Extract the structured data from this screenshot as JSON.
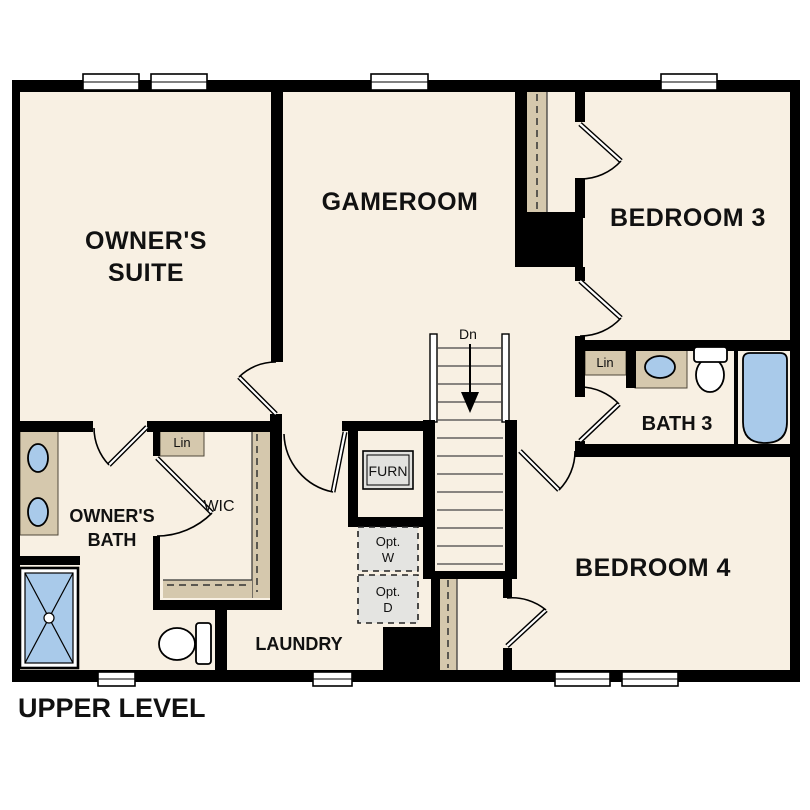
{
  "title": "UPPER LEVEL",
  "rooms": {
    "owners_suite": {
      "line1": "OWNER'S",
      "line2": "SUITE"
    },
    "gameroom": {
      "label": "GAMEROOM"
    },
    "bedroom3": {
      "label": "BEDROOM 3"
    },
    "bath3": {
      "label": "BATH 3"
    },
    "bedroom4": {
      "label": "BEDROOM 4"
    },
    "owners_bath": {
      "line1": "OWNER'S",
      "line2": "BATH"
    },
    "wic": {
      "label": "WIC"
    },
    "laundry": {
      "label": "LAUNDRY"
    }
  },
  "closets": {
    "linen_bath3": "Lin",
    "linen_wic": "Lin"
  },
  "equipment": {
    "furnace": "FURN",
    "opt_washer_line1": "Opt.",
    "opt_washer_line2": "W",
    "opt_dryer_line1": "Opt.",
    "opt_dryer_line2": "D"
  },
  "stairs": {
    "direction_label": "Dn"
  },
  "colors": {
    "wall": "#000000",
    "floor": "#f8f0e3",
    "background": "#ffffff",
    "counter_tan": "#d5c8ad",
    "fixture_blue": "#a9caea",
    "equipment_gray": "#e4e4e1"
  }
}
